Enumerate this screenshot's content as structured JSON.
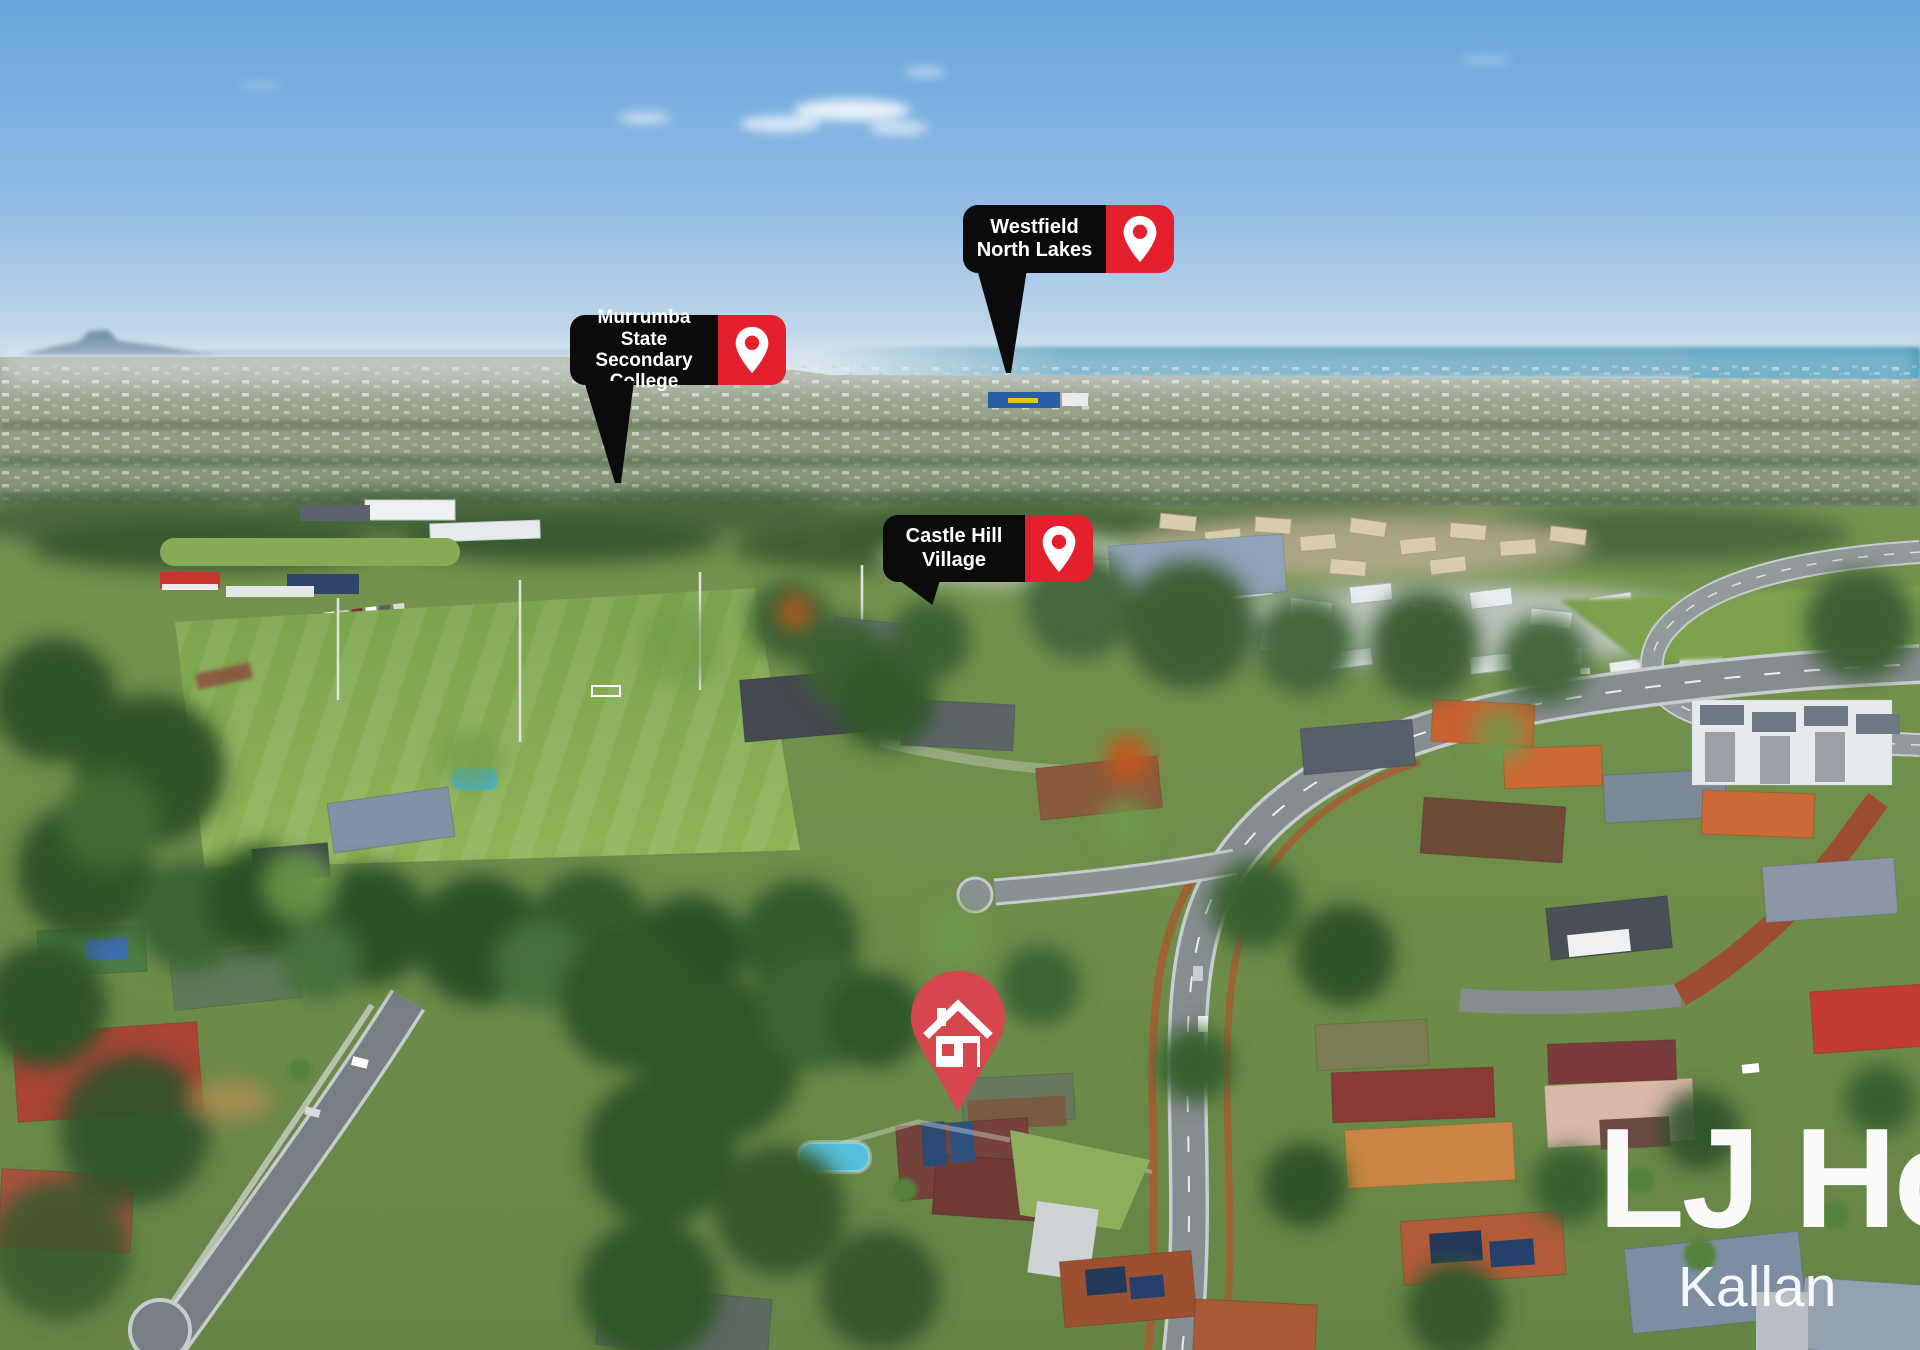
{
  "photo_type": "aerial-suburban-property-photo",
  "markers": [
    {
      "id": "westfield",
      "label": "Westfield North Lakes",
      "icon": "map-pin-icon"
    },
    {
      "id": "murrumba",
      "label": "Murrumba State Secondary College",
      "icon": "map-pin-icon"
    },
    {
      "id": "castlehill",
      "label": "Castle Hill Village",
      "icon": "map-pin-icon"
    }
  ],
  "property_pin": {
    "icon": "house-icon"
  },
  "watermark": {
    "line1": "LJ Hoo",
    "line2": "Kallan"
  },
  "colors": {
    "marker_bg": "#0b0b0c",
    "marker_red": "#e5202e",
    "property_pin_red": "#d6464d",
    "watermark_text": "#ffffff"
  }
}
